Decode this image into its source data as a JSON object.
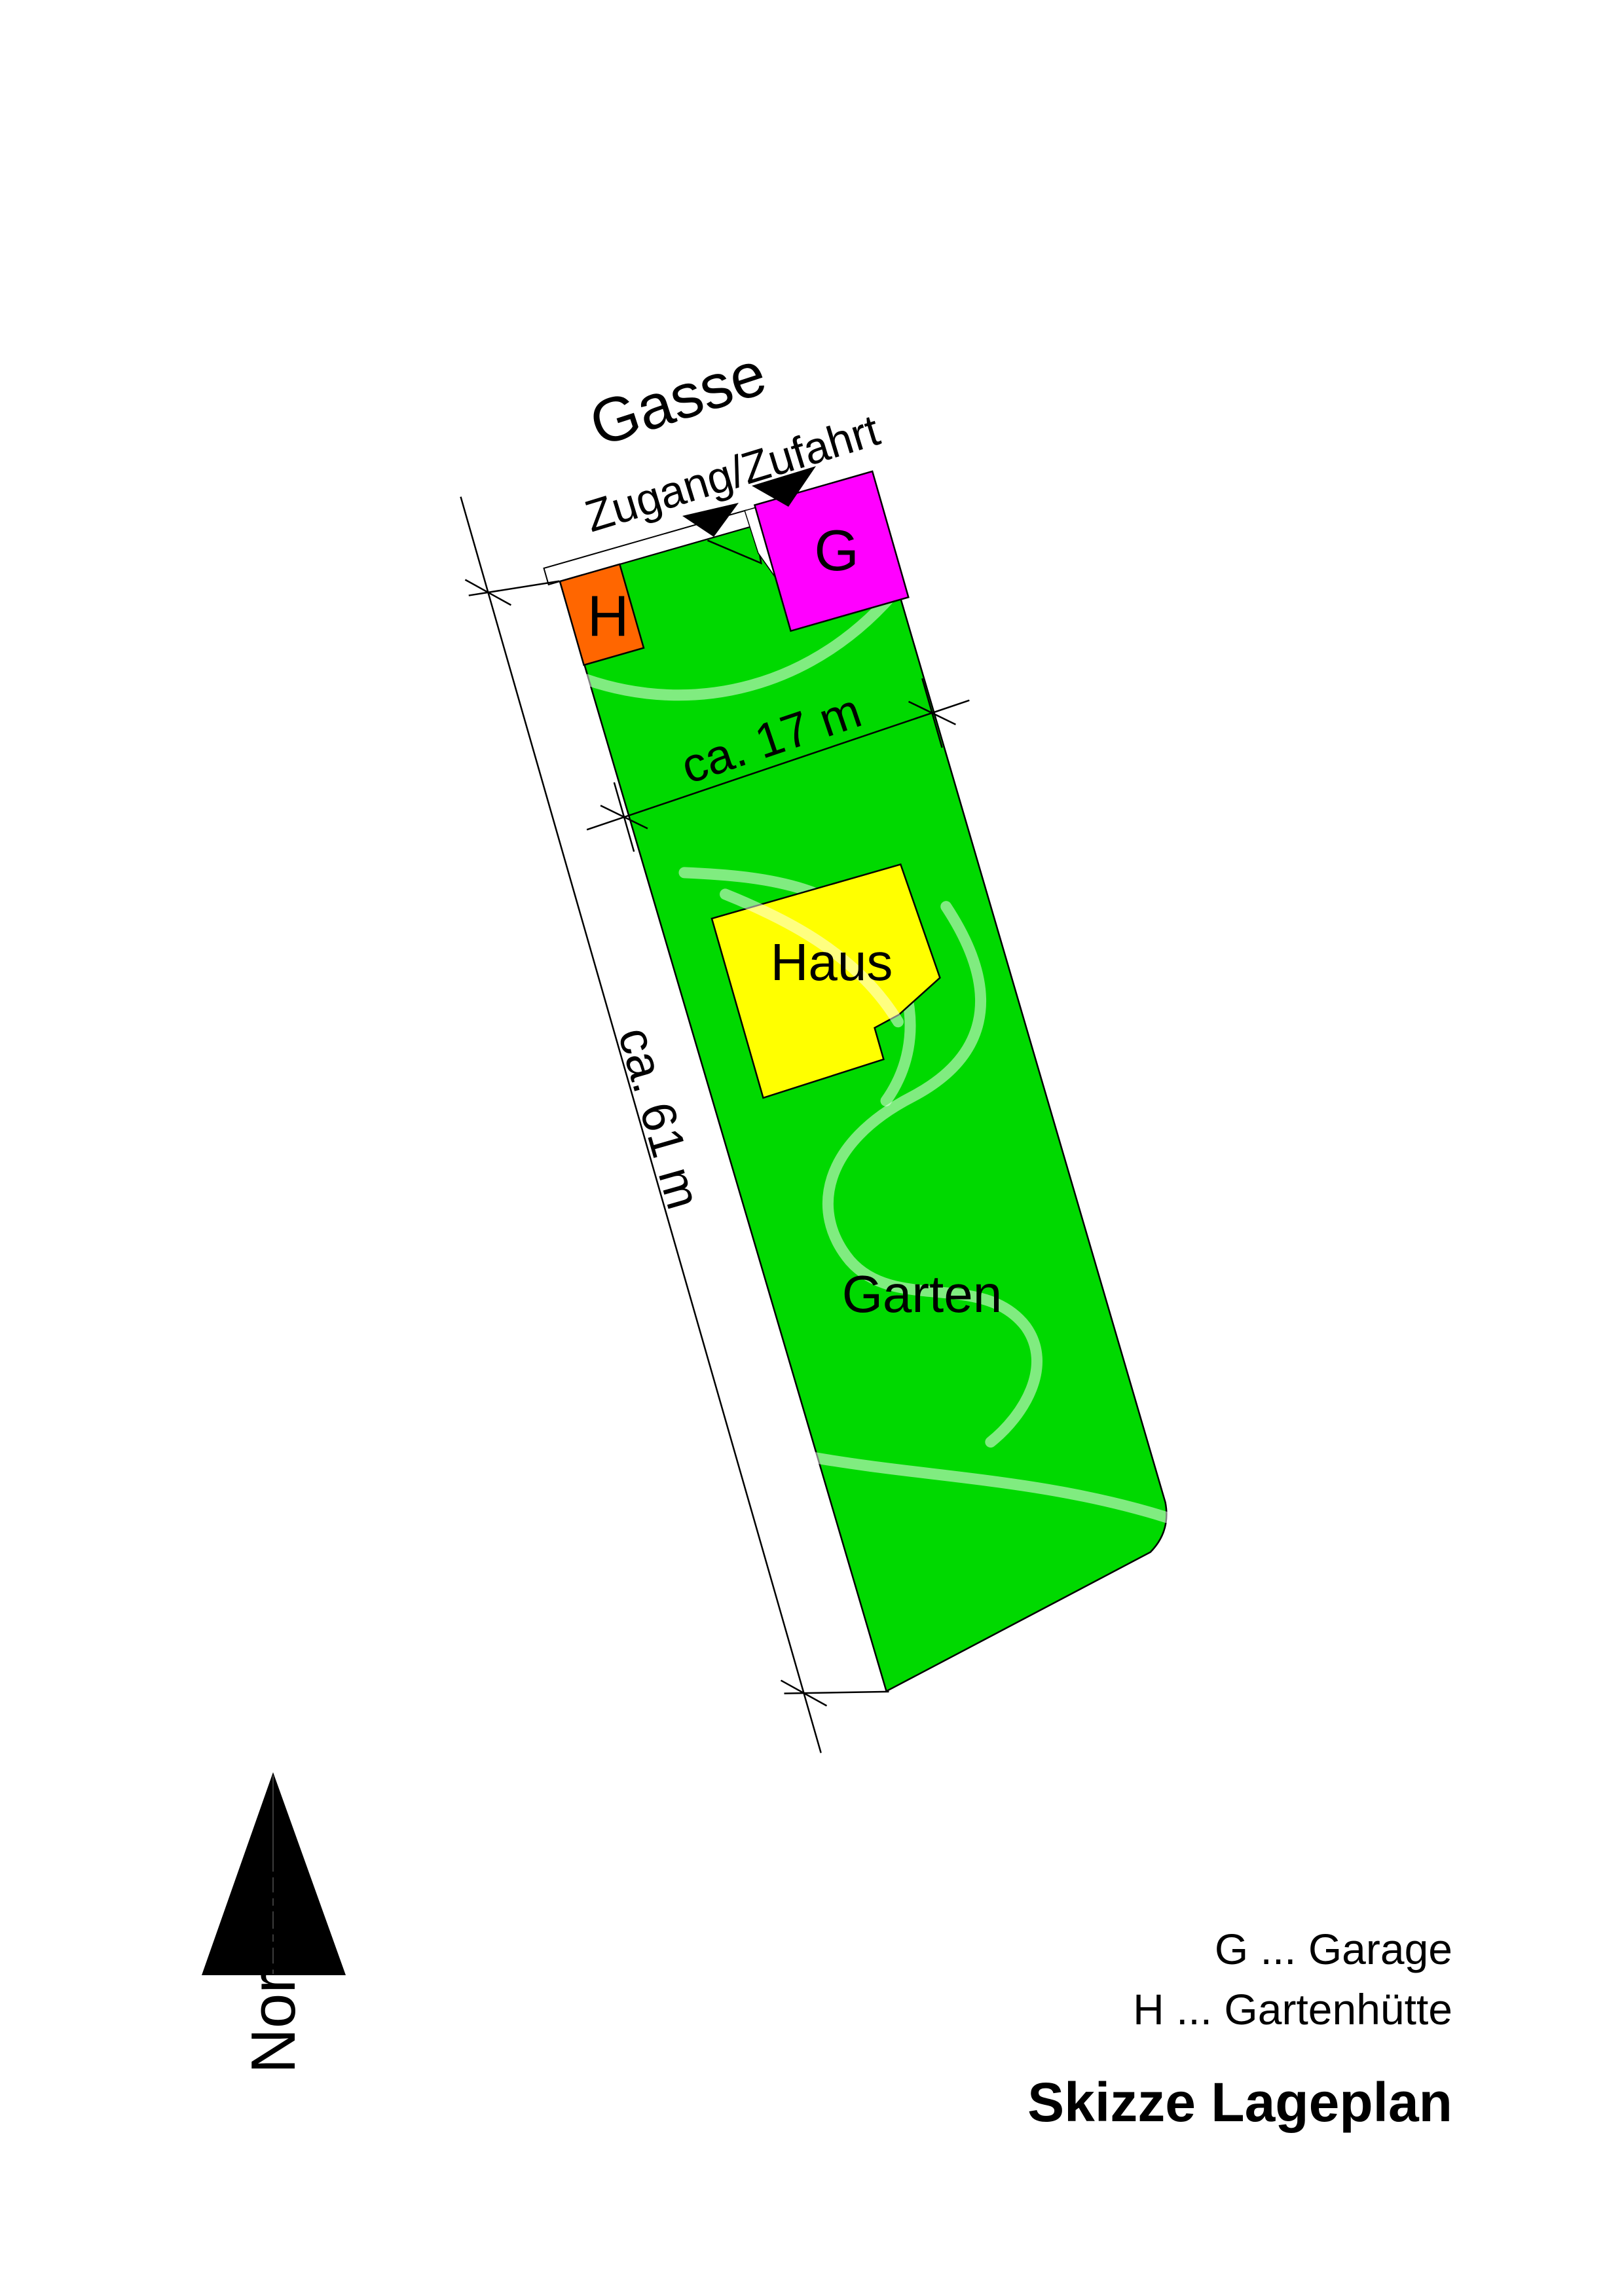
{
  "plan": {
    "street_label": "Gasse",
    "access_label": "Zugang/Zufahrt",
    "garden_label": "Garten",
    "house_label": "Haus",
    "garage_abbrev": "G",
    "huette_abbrev": "H",
    "north_label": "Norden",
    "dimensions": {
      "width_label": "ca. 17 m",
      "length_label": "ca. 61 m"
    }
  },
  "legend": {
    "garage_entry": "G ... Garage",
    "huette_entry": "H ... Gartenhütte"
  },
  "title": "Skizze Lageplan",
  "colors": {
    "parcel": "#00D900",
    "house": "#FFFF00",
    "garage": "#FF00FF",
    "huette": "#FF6600",
    "arrow": "#000000",
    "north": "#000000",
    "paper": "#FFFFFF"
  }
}
